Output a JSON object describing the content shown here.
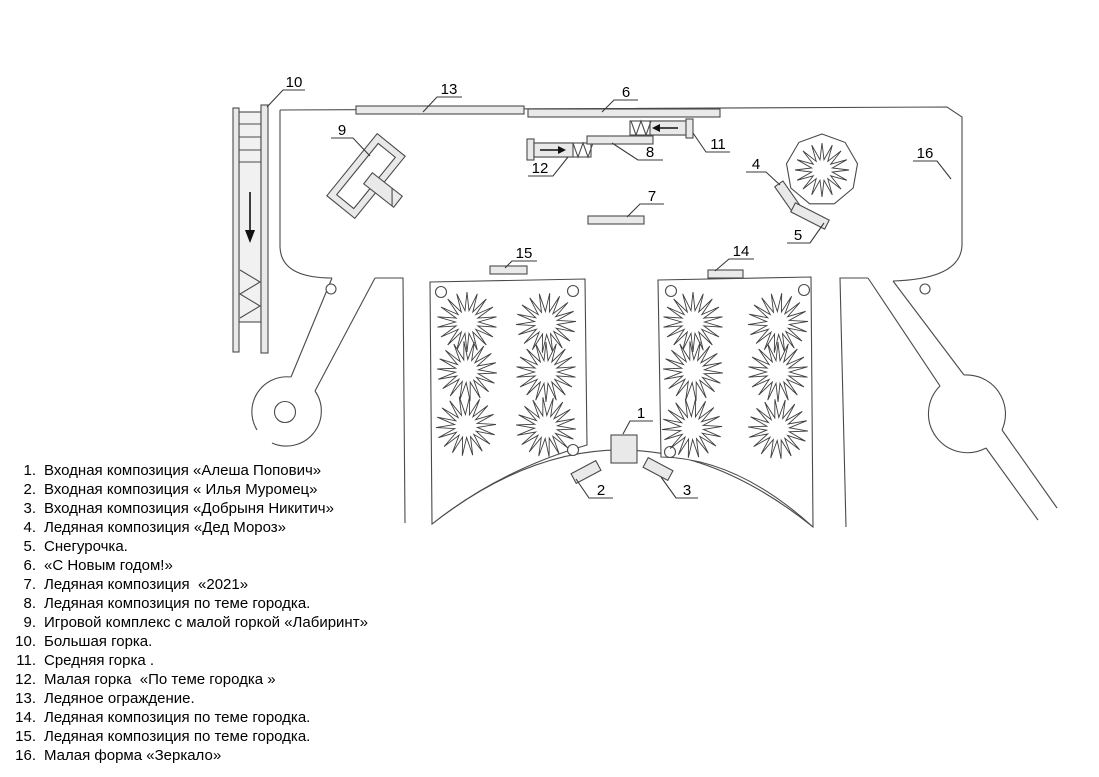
{
  "title": "План ледового городка",
  "callouts": [
    "1",
    "2",
    "3",
    "4",
    "5",
    "6",
    "7",
    "8",
    "9",
    "10",
    "11",
    "12",
    "13",
    "14",
    "15",
    "16"
  ],
  "legend": {
    "items": [
      {
        "num": "1.",
        "text": "Входная композиция «Алеша Попович»"
      },
      {
        "num": "2.",
        "text": "Входная композиция « Илья Муромец»"
      },
      {
        "num": "3.",
        "text": "Входная композиция «Добрыня Никитич»"
      },
      {
        "num": "4.",
        "text": "Ледяная композиция «Дед Мороз»"
      },
      {
        "num": "5.",
        "text": "Снегурочка."
      },
      {
        "num": "6.",
        "text": "«С Новым годом!»"
      },
      {
        "num": "7.",
        "text": "Ледяная композиция  «2021»"
      },
      {
        "num": "8.",
        "text": "Ледяная композиция по теме городка."
      },
      {
        "num": "9.",
        "text": "Игровой комплекс с малой горкой «Лабиринт»"
      },
      {
        "num": "10.",
        "text": "Большая горка."
      },
      {
        "num": "11.",
        "text": "Средняя горка ."
      },
      {
        "num": "12.",
        "text": "Малая горка  «По теме городка »"
      },
      {
        "num": "13.",
        "text": "Ледяное ограждение."
      },
      {
        "num": "14.",
        "text": "Ледяная композиция по теме городка."
      },
      {
        "num": "15.",
        "text": "Ледяная композиция по теме городка."
      },
      {
        "num": "16.",
        "text": "Малая форма «Зеркало»"
      }
    ]
  },
  "symbols": {
    "ice_tree": "starburst",
    "slide_direction_down": "↓",
    "slide_direction_left": "←",
    "slide_direction_right": "→"
  },
  "colors": {
    "line": "#4a4a4a",
    "fill_light": "#e9e9e9",
    "background": "#ffffff",
    "text": "#000000"
  }
}
